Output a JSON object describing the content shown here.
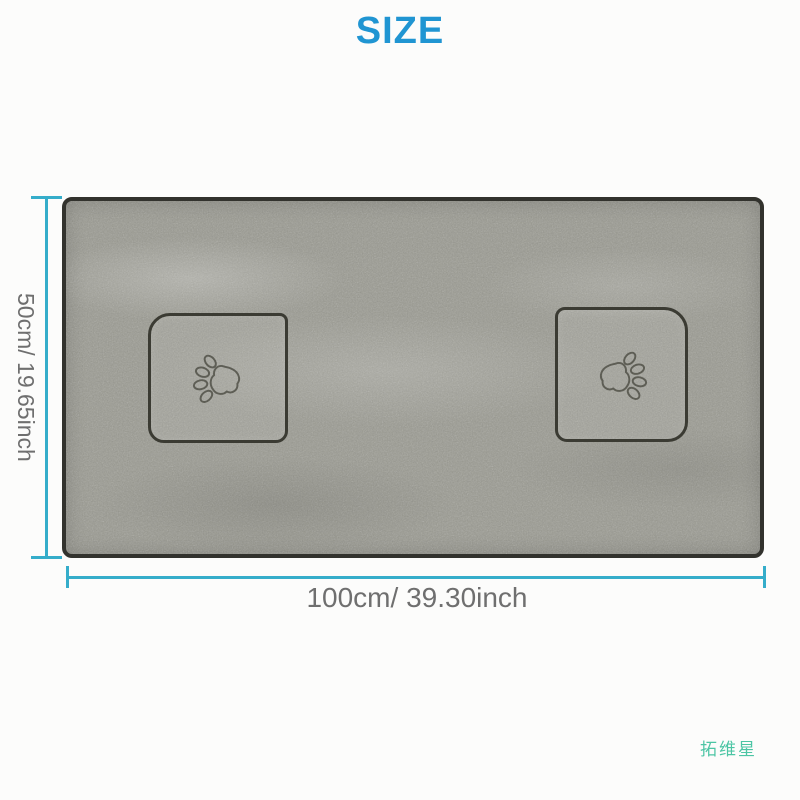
{
  "title": "SIZE",
  "diagram": {
    "height_label": "50cm/ 19.65inch",
    "width_label": "100cm/ 39.30inch"
  },
  "watermark": "拓维星",
  "icons": {
    "paw_print": "paw-print-icon"
  },
  "colors": {
    "title": "#2095d2",
    "dimension_line": "#35adca",
    "label_text": "#6f6f6f",
    "watermark": "#4cc5a4",
    "towel_base": "#9a9a91",
    "towel_border": "#32322d",
    "patch_outline": "#3b3b33",
    "paw_stitch": "#55554d"
  }
}
